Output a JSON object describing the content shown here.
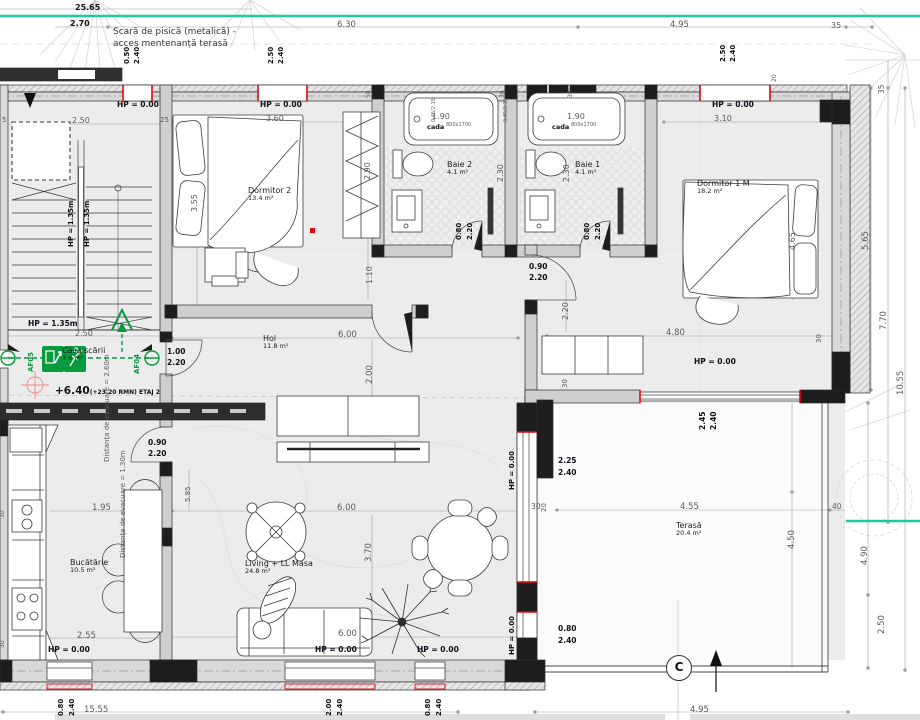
{
  "note_top": {
    "line1": "Scară de pisică (metalică) -",
    "line2": "acces mentenanță terasă"
  },
  "rooms": [
    {
      "name": "Dormitor 2",
      "area": "13.4 m²",
      "x": 248,
      "y": 186
    },
    {
      "name": "Baie 2",
      "area": "4.1 m²",
      "x": 447,
      "y": 160
    },
    {
      "name": "Baie 1",
      "area": "4.1 m²",
      "x": 575,
      "y": 160
    },
    {
      "name": "Dormitor 1 M",
      "area": "18.2 m²",
      "x": 697,
      "y": 179
    },
    {
      "name": "Hol",
      "area": "11.8 m²",
      "x": 263,
      "y": 334
    },
    {
      "name": "Bucătărie",
      "area": "10.5 m²",
      "x": 70,
      "y": 558
    },
    {
      "name": "Living + LL Masa",
      "area": "24.8 m²",
      "x": 245,
      "y": 559
    },
    {
      "name": "Terasă",
      "area": "20.4 m²",
      "x": 676,
      "y": 521
    }
  ],
  "stairwell": {
    "name": "Casa scării",
    "area": "3.6 m²"
  },
  "level_marker": {
    "value": "+6.40",
    "detail": "(+23.20 RMN) ETAJ 2"
  },
  "exit_signs": {
    "left": "AF05",
    "right": "AF04"
  },
  "grid_marker": "C",
  "colors": {
    "teal": "#1fc7a5",
    "green": "#089a3e",
    "red": "#e30613"
  },
  "labels": [
    {
      "t": "25.65",
      "x": 75,
      "y": 4,
      "s": 8,
      "b": 1
    },
    {
      "t": "2.70",
      "x": 70,
      "y": 20,
      "s": 8,
      "b": 1
    },
    {
      "t": "6.30",
      "x": 337,
      "y": 21,
      "s": 8.5
    },
    {
      "t": "4.95",
      "x": 670,
      "y": 21,
      "s": 8.5
    },
    {
      "t": "35",
      "x": 831,
      "y": 22,
      "s": 8
    },
    {
      "t": "0.50",
      "x": 124,
      "y": 64,
      "v": 1,
      "b": 1,
      "s": 7
    },
    {
      "t": "2.40",
      "x": 134,
      "y": 64,
      "v": 1,
      "b": 1,
      "s": 7
    },
    {
      "t": "2.50",
      "x": 268,
      "y": 64,
      "v": 1,
      "b": 1,
      "s": 7
    },
    {
      "t": "2.40",
      "x": 278,
      "y": 64,
      "v": 1,
      "b": 1,
      "s": 7
    },
    {
      "t": "2.50",
      "x": 720,
      "y": 62,
      "v": 1,
      "b": 1,
      "s": 7
    },
    {
      "t": "2.40",
      "x": 730,
      "y": 62,
      "v": 1,
      "b": 1,
      "s": 7
    },
    {
      "t": "HP = 0.00",
      "x": 117,
      "y": 101,
      "b": 1,
      "s": 7.5,
      "n": "hp-label"
    },
    {
      "t": "HP = 0.00",
      "x": 260,
      "y": 101,
      "b": 1,
      "s": 7.5,
      "n": "hp-label"
    },
    {
      "t": "HP = 0.00",
      "x": 712,
      "y": 101,
      "b": 1,
      "s": 7.5,
      "n": "hp-label"
    },
    {
      "t": "2.50",
      "x": 72,
      "y": 117,
      "s": 8
    },
    {
      "t": "5",
      "x": 2,
      "y": 117,
      "s": 7
    },
    {
      "t": "25",
      "x": 160,
      "y": 117,
      "s": 7
    },
    {
      "t": "HP = 1.35m",
      "x": 68,
      "y": 247,
      "v": 1,
      "b": 1,
      "s": 7,
      "n": "hp-label"
    },
    {
      "t": "HP = 1.35m",
      "x": 84,
      "y": 247,
      "v": 1,
      "b": 1,
      "s": 7,
      "n": "hp-label"
    },
    {
      "t": "HP = 1.35m",
      "x": 28,
      "y": 320,
      "b": 1,
      "s": 7.5,
      "n": "hp-label"
    },
    {
      "t": "2.50",
      "x": 75,
      "y": 330,
      "s": 8
    },
    {
      "t": "3.60",
      "x": 266,
      "y": 115,
      "s": 8
    },
    {
      "t": "3.55",
      "x": 191,
      "y": 212,
      "v": 1,
      "s": 8
    },
    {
      "t": "2.90",
      "x": 364,
      "y": 180,
      "v": 1,
      "s": 8
    },
    {
      "t": "1.10",
      "x": 366,
      "y": 284,
      "v": 1,
      "s": 8
    },
    {
      "t": "1.90",
      "x": 432,
      "y": 113,
      "s": 8
    },
    {
      "t": "1.90",
      "x": 567,
      "y": 113,
      "s": 8
    },
    {
      "t": "cada",
      "x": 427,
      "y": 124,
      "s": 6.5,
      "b": 1,
      "n": "tub-label"
    },
    {
      "t": "800x1700",
      "x": 446,
      "y": 123,
      "s": 5,
      "n": "tub-size"
    },
    {
      "t": "cada",
      "x": 552,
      "y": 124,
      "s": 6.5,
      "b": 1,
      "n": "tub-label"
    },
    {
      "t": "800x1700",
      "x": 571,
      "y": 123,
      "s": 5,
      "n": "tub-size"
    },
    {
      "t": "0.45/2.15",
      "x": 432,
      "y": 122,
      "v": 1,
      "s": 5
    },
    {
      "t": "0.45/2.15",
      "x": 504,
      "y": 122,
      "v": 1,
      "s": 5
    },
    {
      "t": "2.30",
      "x": 497,
      "y": 182,
      "v": 1,
      "s": 8
    },
    {
      "t": "2.30",
      "x": 563,
      "y": 182,
      "v": 1,
      "s": 8
    },
    {
      "t": "0.80",
      "x": 456,
      "y": 240,
      "v": 1,
      "b": 1,
      "s": 7
    },
    {
      "t": "2.20",
      "x": 467,
      "y": 240,
      "v": 1,
      "b": 1,
      "s": 7
    },
    {
      "t": "0.80",
      "x": 584,
      "y": 240,
      "v": 1,
      "b": 1,
      "s": 7
    },
    {
      "t": "2.20",
      "x": 595,
      "y": 240,
      "v": 1,
      "b": 1,
      "s": 7
    },
    {
      "t": "50",
      "x": 366,
      "y": 98,
      "v": 1,
      "s": 6
    },
    {
      "t": "30",
      "x": 500,
      "y": 98,
      "v": 1,
      "s": 6
    },
    {
      "t": "30",
      "x": 568,
      "y": 98,
      "v": 1,
      "s": 6
    },
    {
      "t": "20",
      "x": 772,
      "y": 82,
      "v": 1,
      "s": 6
    },
    {
      "t": "3.10",
      "x": 714,
      "y": 115,
      "s": 8
    },
    {
      "t": "4.65",
      "x": 789,
      "y": 250,
      "v": 1,
      "s": 8
    },
    {
      "t": "1.00",
      "x": 167,
      "y": 348,
      "b": 1,
      "s": 7.5
    },
    {
      "t": "2.20",
      "x": 167,
      "y": 359,
      "b": 1,
      "s": 7.5
    },
    {
      "t": "6.00",
      "x": 338,
      "y": 331,
      "s": 8.5
    },
    {
      "t": "2.00",
      "x": 366,
      "y": 384,
      "v": 1,
      "s": 8.5
    },
    {
      "t": "0.90",
      "x": 529,
      "y": 263,
      "b": 1,
      "s": 7.5
    },
    {
      "t": "2.20",
      "x": 529,
      "y": 274,
      "b": 1,
      "s": 7.5
    },
    {
      "t": "2.20",
      "x": 562,
      "y": 320,
      "v": 1,
      "s": 8
    },
    {
      "t": "4.80",
      "x": 666,
      "y": 329,
      "s": 8.5
    },
    {
      "t": "HP = 0.00",
      "x": 694,
      "y": 358,
      "b": 1,
      "s": 7.5,
      "n": "hp-label"
    },
    {
      "t": "30",
      "x": 816,
      "y": 343,
      "v": 1,
      "s": 7
    },
    {
      "t": "30",
      "x": 562,
      "y": 388,
      "v": 1,
      "s": 7
    },
    {
      "t": "Distanța de evacuare = 2.60m",
      "x": 104,
      "y": 462,
      "v": 1,
      "s": 7,
      "n": "evacuation-note"
    },
    {
      "t": "Distanța de evacuare = 1.30m",
      "x": 120,
      "y": 558,
      "v": 1,
      "s": 7,
      "n": "evacuation-note"
    },
    {
      "t": "0.90",
      "x": 148,
      "y": 439,
      "b": 1,
      "s": 7.5
    },
    {
      "t": "2.20",
      "x": 148,
      "y": 450,
      "b": 1,
      "s": 7.5
    },
    {
      "t": "1.95",
      "x": 92,
      "y": 504,
      "s": 8.5
    },
    {
      "t": "2.55",
      "x": 77,
      "y": 632,
      "s": 8.5
    },
    {
      "t": "HP = 0.00",
      "x": 48,
      "y": 646,
      "b": 1,
      "s": 7.5,
      "n": "hp-label"
    },
    {
      "t": "6.00",
      "x": 337,
      "y": 504,
      "s": 8.5
    },
    {
      "t": "3.70",
      "x": 365,
      "y": 562,
      "v": 1,
      "s": 8.5
    },
    {
      "t": "6.00",
      "x": 338,
      "y": 630,
      "s": 8.5
    },
    {
      "t": "HP = 0.00",
      "x": 315,
      "y": 646,
      "b": 1,
      "s": 7.5,
      "n": "hp-label"
    },
    {
      "t": "HP = 0.00",
      "x": 417,
      "y": 646,
      "b": 1,
      "s": 7.5,
      "n": "hp-label"
    },
    {
      "t": "5.85",
      "x": 185,
      "y": 502,
      "v": 1,
      "s": 7
    },
    {
      "t": "HP = 0.00",
      "x": 509,
      "y": 490,
      "v": 1,
      "b": 1,
      "s": 7,
      "n": "hp-label"
    },
    {
      "t": "HP = 0.00",
      "x": 509,
      "y": 655,
      "v": 1,
      "b": 1,
      "s": 7,
      "n": "hp-label"
    },
    {
      "t": "2.45",
      "x": 699,
      "y": 430,
      "v": 1,
      "b": 1,
      "s": 7.5
    },
    {
      "t": "2.40",
      "x": 710,
      "y": 430,
      "v": 1,
      "b": 1,
      "s": 7.5
    },
    {
      "t": "2.25",
      "x": 558,
      "y": 457,
      "b": 1,
      "s": 7.5
    },
    {
      "t": "2.40",
      "x": 558,
      "y": 469,
      "b": 1,
      "s": 7.5
    },
    {
      "t": "4.55",
      "x": 680,
      "y": 503,
      "s": 8.5
    },
    {
      "t": "40",
      "x": 832,
      "y": 503,
      "s": 7.5
    },
    {
      "t": "30",
      "x": 531,
      "y": 503,
      "s": 7.5
    },
    {
      "t": "20",
      "x": 541,
      "y": 512,
      "v": 1,
      "s": 7
    },
    {
      "t": "4.50",
      "x": 788,
      "y": 549,
      "v": 1,
      "s": 8.5
    },
    {
      "t": "0.80",
      "x": 558,
      "y": 625,
      "b": 1,
      "s": 7.5
    },
    {
      "t": "2.40",
      "x": 558,
      "y": 637,
      "b": 1,
      "s": 7.5
    },
    {
      "t": "4.95",
      "x": 690,
      "y": 706,
      "s": 8.5
    },
    {
      "t": "35",
      "x": 878,
      "y": 94,
      "v": 1,
      "s": 7.5
    },
    {
      "t": "5.65",
      "x": 862,
      "y": 250,
      "v": 1,
      "s": 8.5
    },
    {
      "t": "7.70",
      "x": 880,
      "y": 330,
      "v": 1,
      "s": 8.5
    },
    {
      "t": "10.55",
      "x": 897,
      "y": 395,
      "v": 1,
      "s": 8.5
    },
    {
      "t": "4.90",
      "x": 861,
      "y": 565,
      "v": 1,
      "s": 8.5
    },
    {
      "t": "2.50",
      "x": 878,
      "y": 634,
      "v": 1,
      "s": 8.5
    },
    {
      "t": "15.55",
      "x": 84,
      "y": 706,
      "s": 8.5
    },
    {
      "t": "0.80",
      "x": 58,
      "y": 716,
      "v": 1,
      "b": 1,
      "s": 7
    },
    {
      "t": "2.40",
      "x": 69,
      "y": 716,
      "v": 1,
      "b": 1,
      "s": 7
    },
    {
      "t": "2.00",
      "x": 326,
      "y": 716,
      "v": 1,
      "b": 1,
      "s": 7
    },
    {
      "t": "2.40",
      "x": 337,
      "y": 716,
      "v": 1,
      "b": 1,
      "s": 7
    },
    {
      "t": "0.80",
      "x": 425,
      "y": 716,
      "v": 1,
      "b": 1,
      "s": 7
    },
    {
      "t": "2.40",
      "x": 436,
      "y": 716,
      "v": 1,
      "b": 1,
      "s": 7
    },
    {
      "t": "30",
      "x": 0,
      "y": 518,
      "v": 1,
      "s": 6
    },
    {
      "t": "30",
      "x": 0,
      "y": 648,
      "v": 1,
      "s": 6
    }
  ]
}
